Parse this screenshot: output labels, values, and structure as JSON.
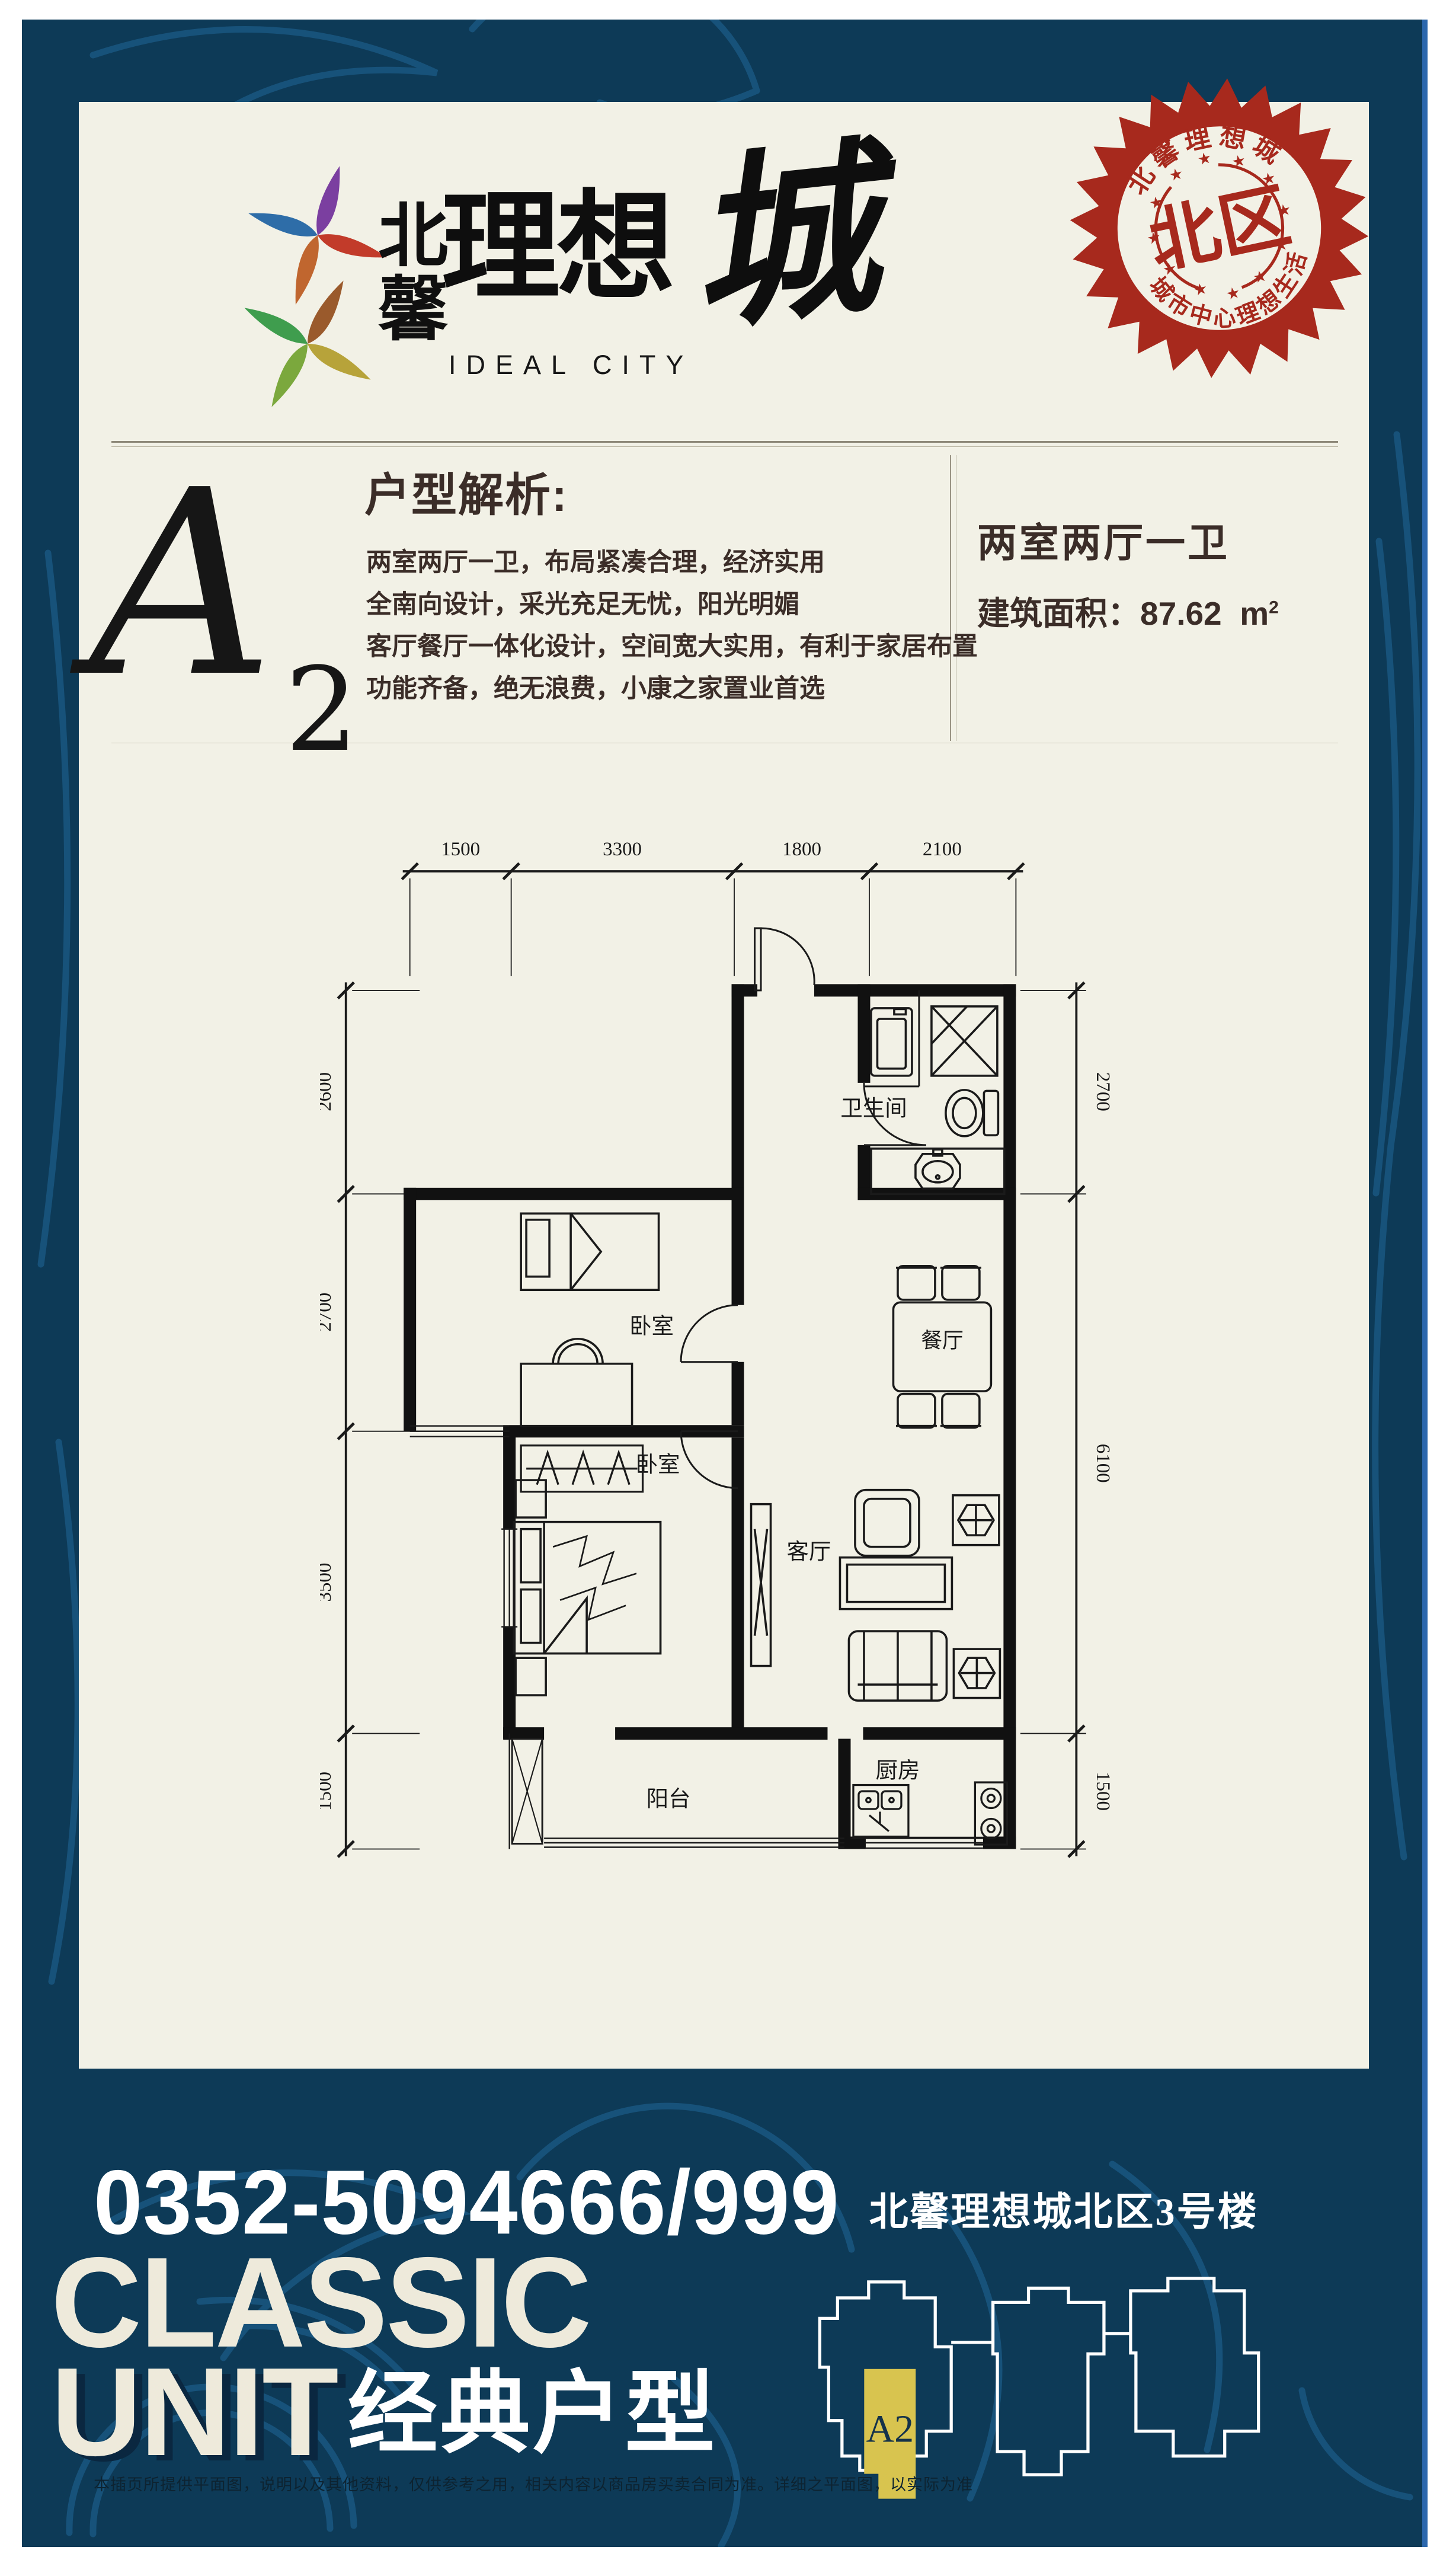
{
  "colors": {
    "navy": "#0d3a57",
    "swirl": "#1e6190",
    "cream_card": "#f2f1e6",
    "stamp_red": "#a7291d",
    "text_brown": "#3b2d28",
    "unit_yellow": "#d8c44f",
    "frame_blue": "#2b67ad"
  },
  "logo": {
    "cn_char1": "北",
    "cn_char2": "馨",
    "main": "理想",
    "calligraphy": "城",
    "latin": "IDEAL CITY"
  },
  "stamp": {
    "arc_top": "北馨理想城",
    "center": "北区",
    "arc_bottom": "城市中心理想生活"
  },
  "intro": {
    "unit_letter": "A",
    "unit_number": "2",
    "heading": "户型解析:",
    "lines": [
      "两室两厅一卫，布局紧凑合理，经济实用",
      "全南向设计，采光充足无忧，阳光明媚",
      "客厅餐厅一体化设计，空间宽大实用，有利于家居布置",
      "功能齐备，绝无浪费，小康之家置业首选"
    ]
  },
  "summary": {
    "layout": "两室两厅一卫",
    "area_label": "建筑面积：",
    "area_value": "87.62",
    "area_unit_m": "m",
    "area_unit_exp": "2"
  },
  "floor_plan": {
    "dims_top": [
      "1500",
      "3300",
      "1800",
      "2100"
    ],
    "dims_left": [
      "2600",
      "2700",
      "3500",
      "1500"
    ],
    "dims_right": [
      "2700",
      "6100",
      "1500"
    ],
    "rooms": {
      "bathroom": "卫生间",
      "bedroom1": "卧室",
      "bedroom2": "卧室",
      "dining": "餐厅",
      "living": "客厅",
      "balcony": "阳台",
      "kitchen": "厨房"
    }
  },
  "footer": {
    "phone": "0352-5094666/999",
    "classic": "CLASSIC",
    "unit_word": "UNIT",
    "classic_cn": "经典户型",
    "building_title": "北馨理想城北区3号楼",
    "key_unit_label": "A2",
    "disclaimer": "本插页所提供平面图，说明以及其他资料，仅供参考之用，相关内容以商品房买卖合同为准。详细之平面图，以实际为准"
  }
}
